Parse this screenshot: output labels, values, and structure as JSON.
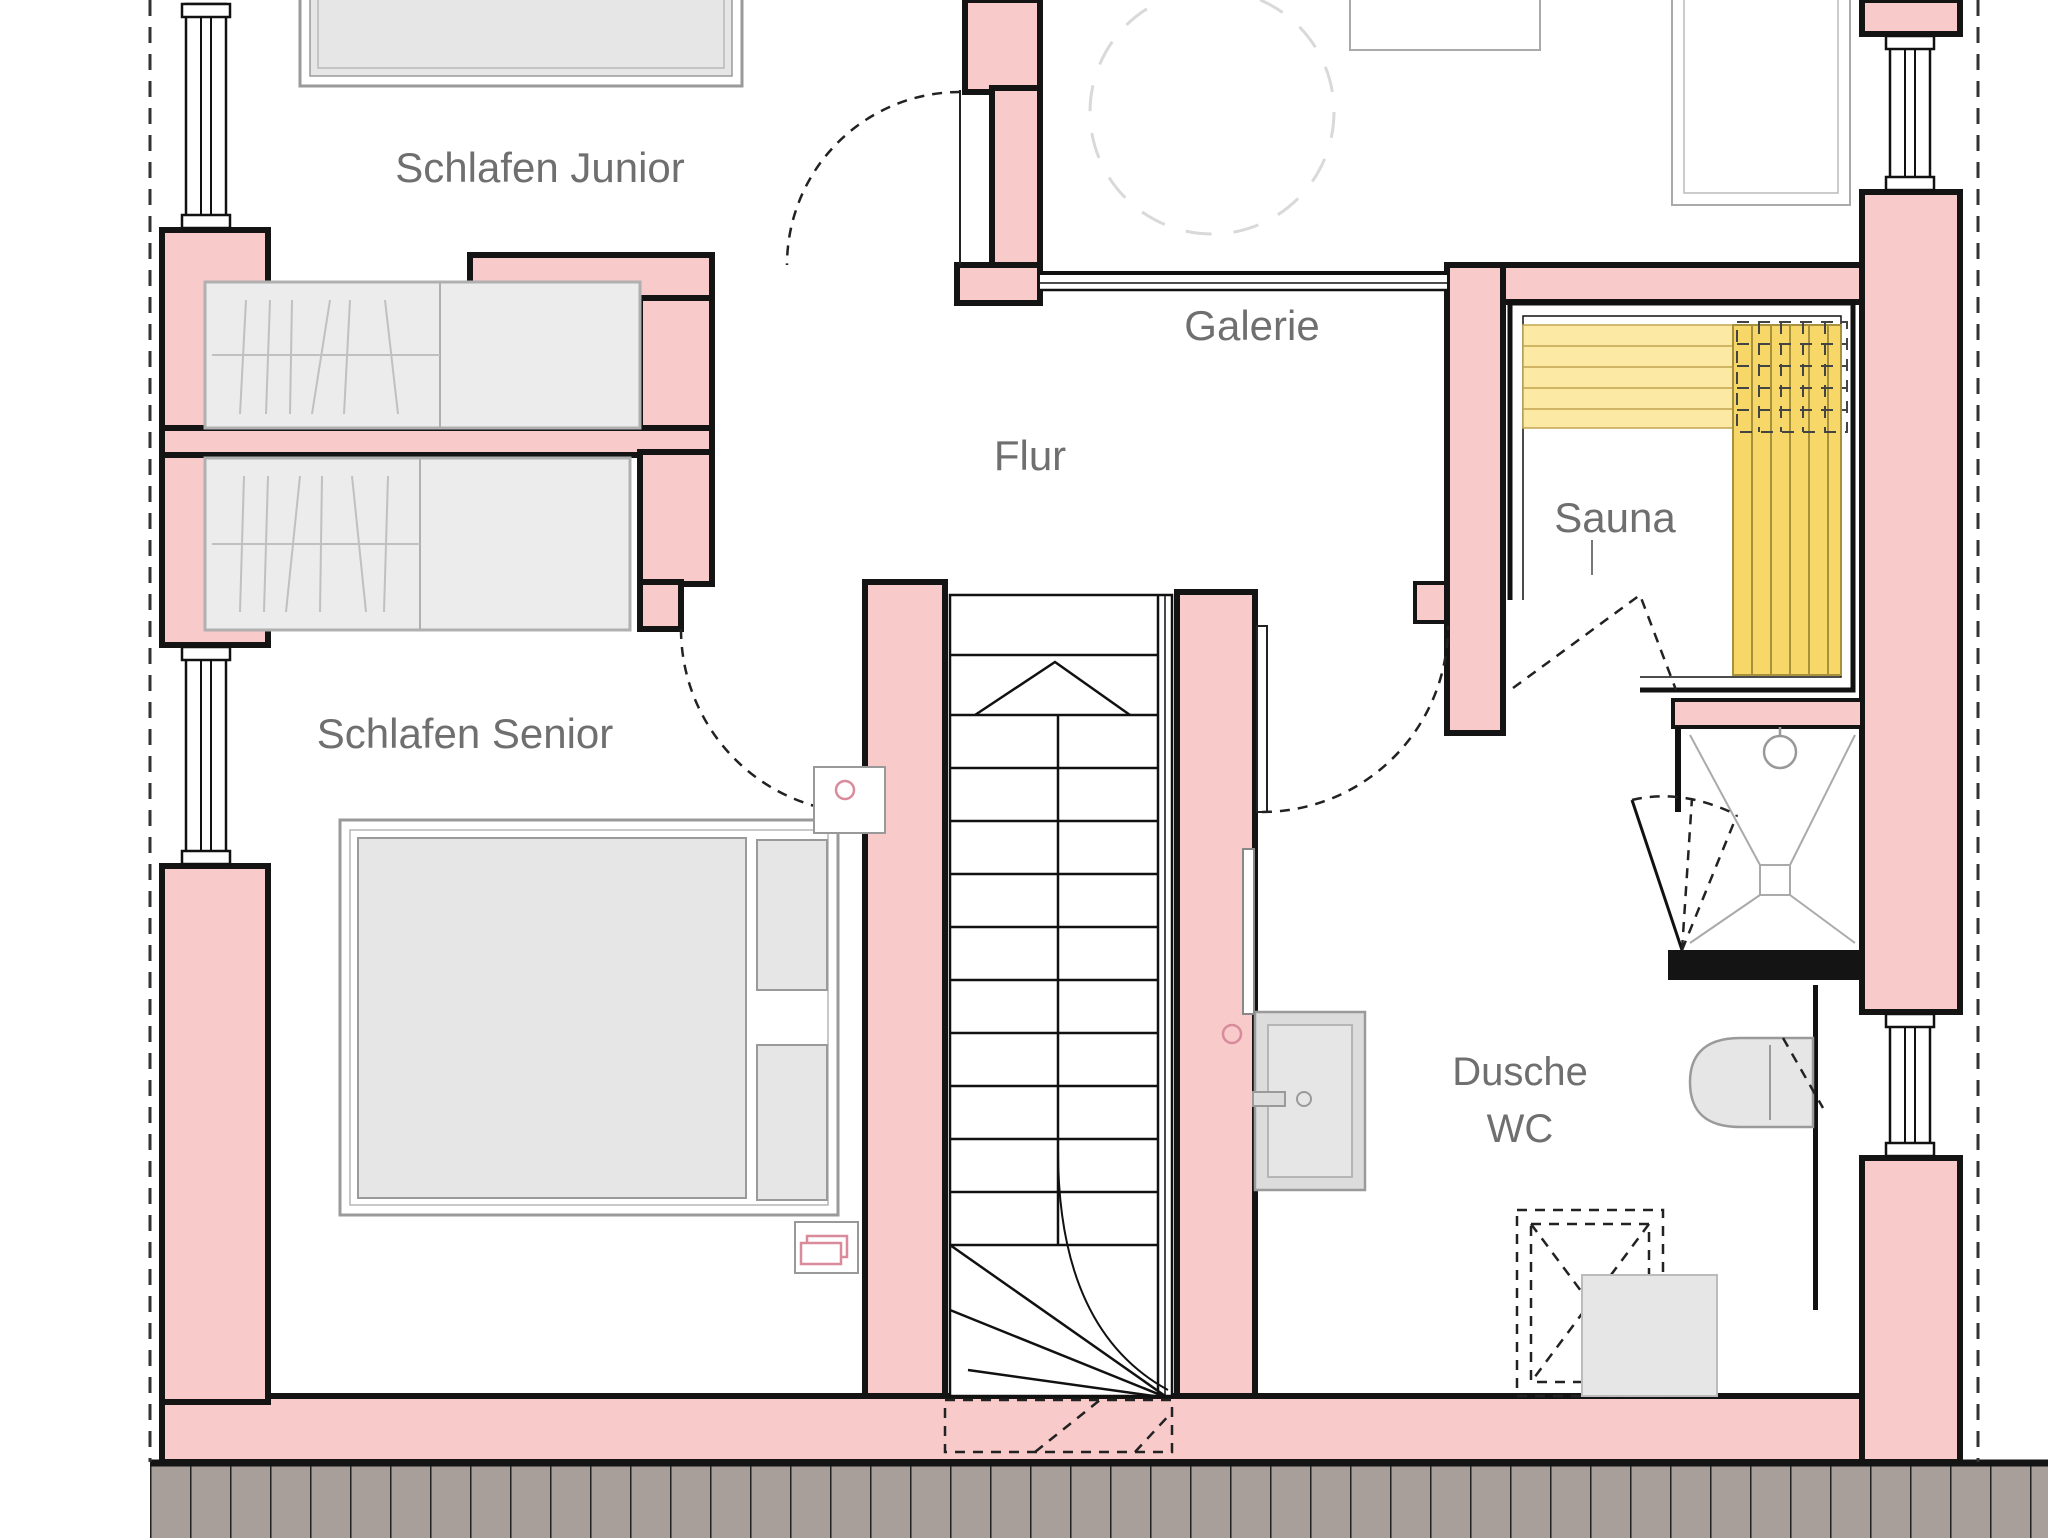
{
  "rooms": {
    "schlafen_junior": {
      "label": "Schlafen Junior"
    },
    "galerie": {
      "label": "Galerie"
    },
    "flur": {
      "label": "Flur"
    },
    "sauna": {
      "label": "Sauna"
    },
    "schlafen_senior": {
      "label": "Schlafen Senior"
    },
    "dusche_wc": {
      "label_line1": "Dusche",
      "label_line2": "WC"
    }
  },
  "colors": {
    "wall": "#f9caca",
    "wall_outline": "#141414",
    "furniture_fill": "#e6e6e6",
    "furniture_stroke": "#9a9a9a",
    "bench_light": "#fce9a4",
    "bench_dark": "#f7d767",
    "bench_line": "#c2a54e",
    "deck_fill": "#a89e9a",
    "deck_line": "#222222",
    "label_color": "#6f6f6f",
    "accent_pink": "#d98b9b"
  }
}
